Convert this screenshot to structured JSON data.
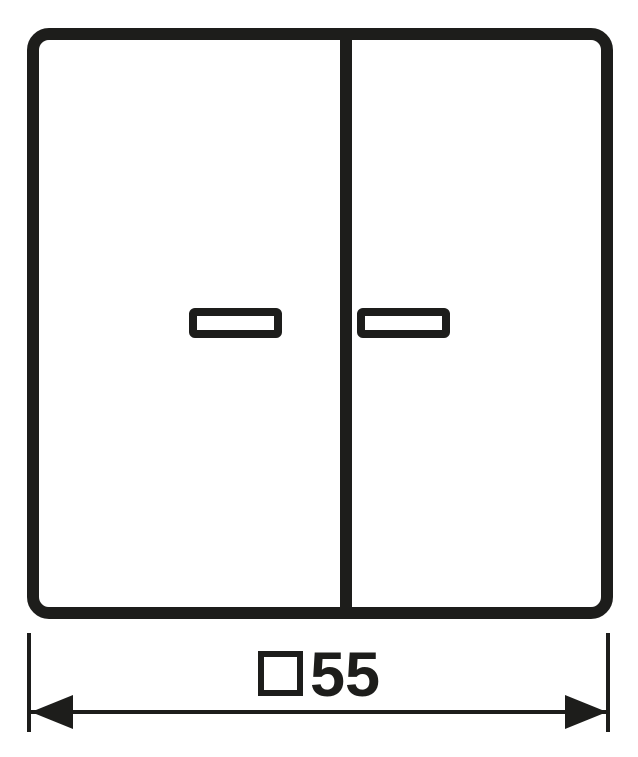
{
  "drawing": {
    "kind": "technical-dimension-drawing",
    "background_color": "#ffffff",
    "line_color": "#1d1d1b"
  },
  "plate": {
    "sections": 2,
    "indicator_windows": 2
  },
  "dimension": {
    "symbol": "□",
    "value": "55",
    "label": "□55"
  },
  "icons": {
    "square_symbol": "□",
    "left_arrowhead": "◀",
    "right_arrowhead": "▶"
  }
}
